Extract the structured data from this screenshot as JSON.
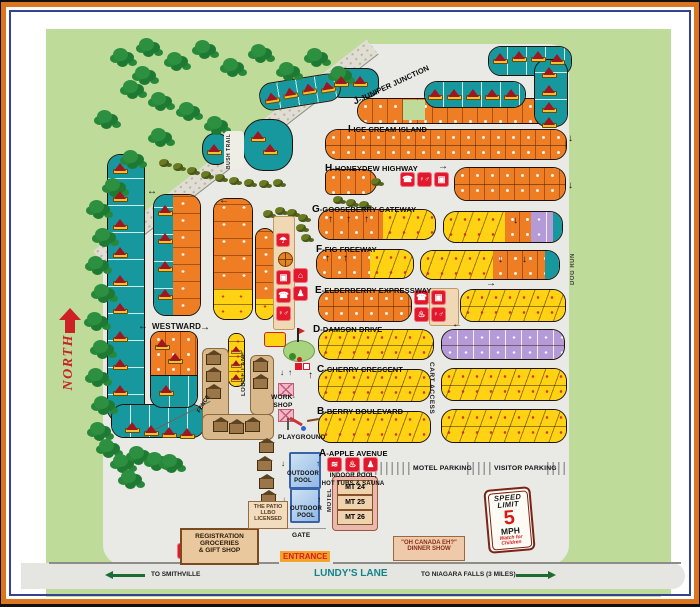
{
  "streets": [
    {
      "letter": "J",
      "name": "-JUNIPER JUNCTION"
    },
    {
      "letter": "I",
      "name": "-ICE CREAM ISLAND"
    },
    {
      "letter": "H",
      "name": "-HONEYDEW HIGHWAY"
    },
    {
      "letter": "G",
      "name": "-GOOSEBERRY GATEWAY"
    },
    {
      "letter": "F",
      "name": "-FIG FREEWAY"
    },
    {
      "letter": "E",
      "name": "-ELDERBERRY EXPRESSWAY"
    },
    {
      "letter": "D",
      "name": "-DAMSON DRIVE"
    },
    {
      "letter": "C",
      "name": "-CHERRY CRESCENT"
    },
    {
      "letter": "B",
      "name": "-BERRY BOULEVARD"
    },
    {
      "letter": "A",
      "name": "-APPLE AVENUE"
    }
  ],
  "areas": {
    "north": "NORTH",
    "bush_trail": "BUSH TRAIL",
    "dog_run": "DOG RUN",
    "cart_access": "CART ACCESS",
    "westward": "WESTWARD",
    "lodge_lane": "LODGE LANE",
    "fence": "FENCE",
    "work_shop": "WORK-\nSHOP",
    "playground": "PLAYGROUND",
    "gate": "GATE",
    "motel": "MOTEL"
  },
  "parking": {
    "motel": "MOTEL PARKING",
    "visitor": "VISITOR PARKING"
  },
  "facilities": {
    "outdoor_pool_upper": "OUTDOOR\nPOOL",
    "outdoor_pool_lower": "OUTDOOR\nPOOL",
    "indoor_pool": "INDOOR POOL,\nHOT TUBS & SAUNA",
    "patio": "THE PATIO\nLLBO\nLICENSED",
    "registration": "REGISTRATION\nGROCERIES\n& GIFT SHOP",
    "dinner_show": "\"OH CANADA EH?\"\nDINNER SHOW",
    "motel_units": [
      "MT 24",
      "MT 25",
      "MT 26"
    ]
  },
  "signs": {
    "entrance": "ENTRANCE",
    "speed_limit": {
      "line1": "SPEED",
      "line2": "LIMIT",
      "value": "5",
      "unit": "MPH",
      "warning": "Watch for\nChildren"
    }
  },
  "roads": {
    "lundys_lane": "LUNDY'S LANE",
    "to_smithville": "TO SMITHVILLE",
    "to_niagara": "TO NIAGARA FALLS (3 MILES)"
  },
  "glyphs": {
    "phone": "☎",
    "restroom": "♀♂",
    "laundry": "▣",
    "hot_tub": "♨",
    "pool": "≋",
    "sauna": "♟",
    "pavilion": "☂",
    "games": "⌂",
    "person": "♟"
  },
  "arrows": {
    "up": "↑",
    "down": "↓",
    "left": "←",
    "right": "→",
    "both": "↔"
  },
  "colors": {
    "site_orange": "#ef7d23",
    "site_yellow": "#ffd314",
    "site_teal": "#17989e",
    "site_purple": "#b49bd8",
    "amenity_red": "#e2182c",
    "grass_green": "#bedb9a",
    "road_gray": "#e9e9e6",
    "border_orange": "#dc7520",
    "border_navy": "#37428e"
  }
}
